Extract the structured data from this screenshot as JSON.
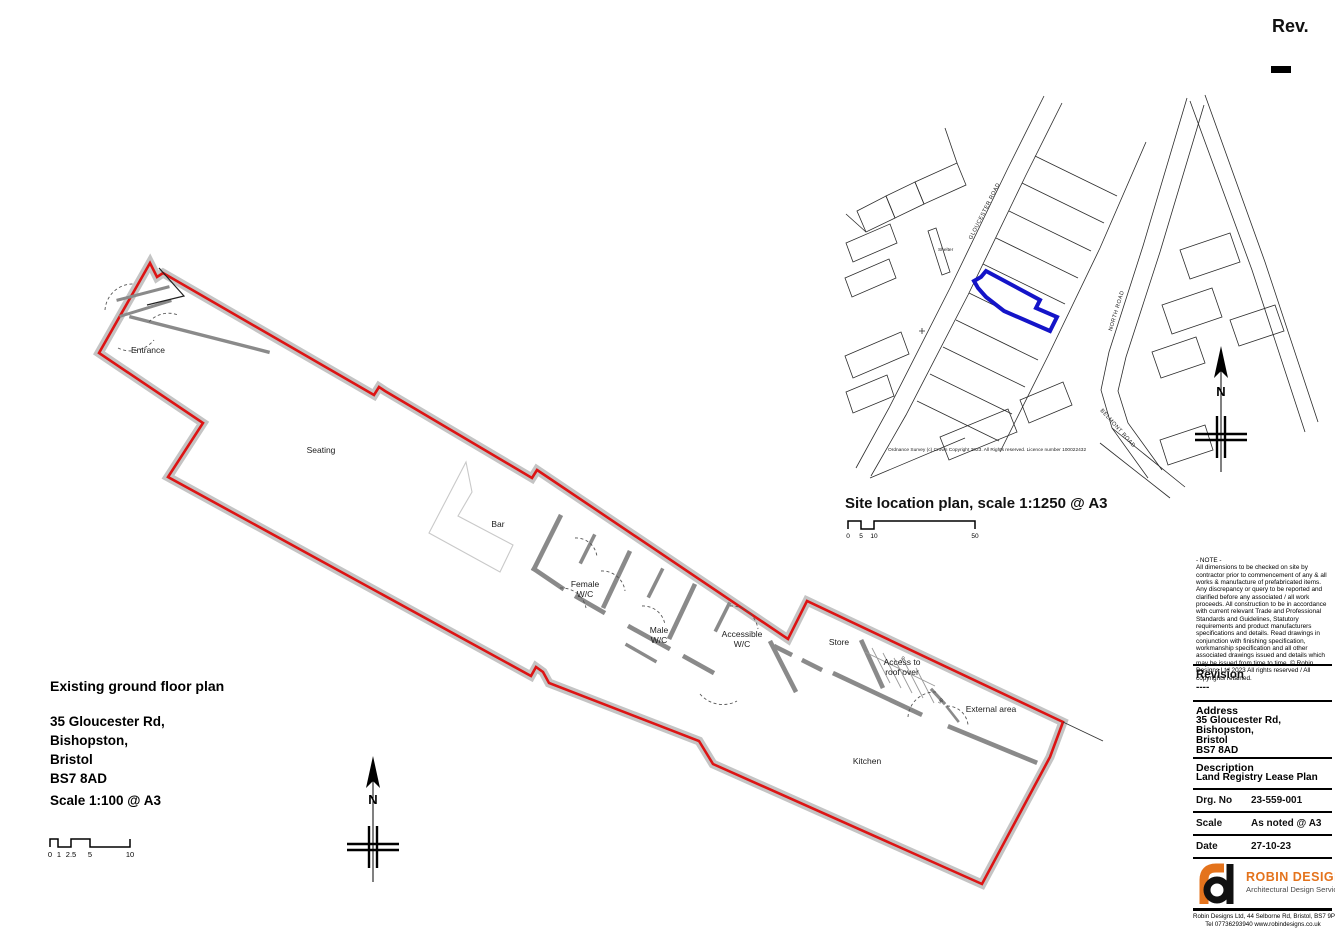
{
  "page": {
    "rev_label": "Rev.",
    "rev_value": ""
  },
  "north_label": "N",
  "floor_plan": {
    "title": "Existing ground floor plan",
    "address_lines": [
      "35 Gloucester Rd,",
      "Bishopston,",
      "Bristol",
      "BS7 8AD"
    ],
    "scale_label": "Scale 1:100 @ A3",
    "scale_bar_ticks": [
      "0",
      "1",
      "2.5",
      "5",
      "10"
    ],
    "rooms": [
      {
        "label": "Entrance"
      },
      {
        "label": "Seating"
      },
      {
        "label": "Bar"
      },
      {
        "label": "Female\nW/C"
      },
      {
        "label": "Male\nW/C"
      },
      {
        "label": "Accessible\nW/C"
      },
      {
        "label": "Store"
      },
      {
        "label": "Access to\nroof over"
      },
      {
        "label": "External area"
      },
      {
        "label": "Kitchen"
      }
    ],
    "stairs_up_label": "up",
    "boundary_color": "#dd1414",
    "wall_color": "#c4c4c4"
  },
  "site_plan": {
    "title": "Site location plan, scale 1:1250 @ A3",
    "copyright": "Ordnance Survey (c) Crown Copyright 2023.  All Rights reserved.  Licence number 100022432",
    "scale_bar_ticks": [
      "0",
      "5",
      "10",
      "50"
    ],
    "road_labels": [
      "GLOUCESTER ROAD",
      "NORTH ROAD",
      "BELMONT ROAD"
    ],
    "shelter_label": "Shelter",
    "plot_color": "#1414c8"
  },
  "title_block": {
    "note_title": "- NOTE -",
    "note_body": "All dimensions to be checked on site by contractor prior to commencement of any & all works & manufacture of prefabricated items.  Any discrepancy or query to be reported and clarified before  any associated / all work proceeds. All construction to be in accordance with current relevant Trade and Professional  Standards and Guidelines, Statutory requirements and product manufacturers specifications and details. Read drawings in conjunction with finishing specification, workmanship specification and all other associated drawings issued and details which may be issued from time to time.",
    "note_copyright": "© Robin Designs Ltd 2023 All rights reserved / All copyrights retained.",
    "revision_label": "Revision",
    "revision_value": "----",
    "address_label": "Address",
    "address_lines": [
      "35 Gloucester Rd,",
      "Bishopston,",
      "Bristol",
      "BS7 8AD"
    ],
    "description_label": "Description",
    "description_value": "Land Registry Lease Plan",
    "drg_no_label": "Drg. No",
    "drg_no_value": "23-559-001",
    "scale_label": "Scale",
    "scale_value": "As noted @ A3",
    "date_label": "Date",
    "date_value": "27-10-23",
    "logo": {
      "company": "ROBIN DESIGNS",
      "tagline": "Architectural Design Services",
      "accent_color": "#e4731c"
    },
    "footer_line1": "Robin Designs Ltd, 44 Selborne Rd, Bristol, BS7 9PH",
    "footer_line2": "Tel 07736293940 www.robindesigns.co.uk"
  }
}
